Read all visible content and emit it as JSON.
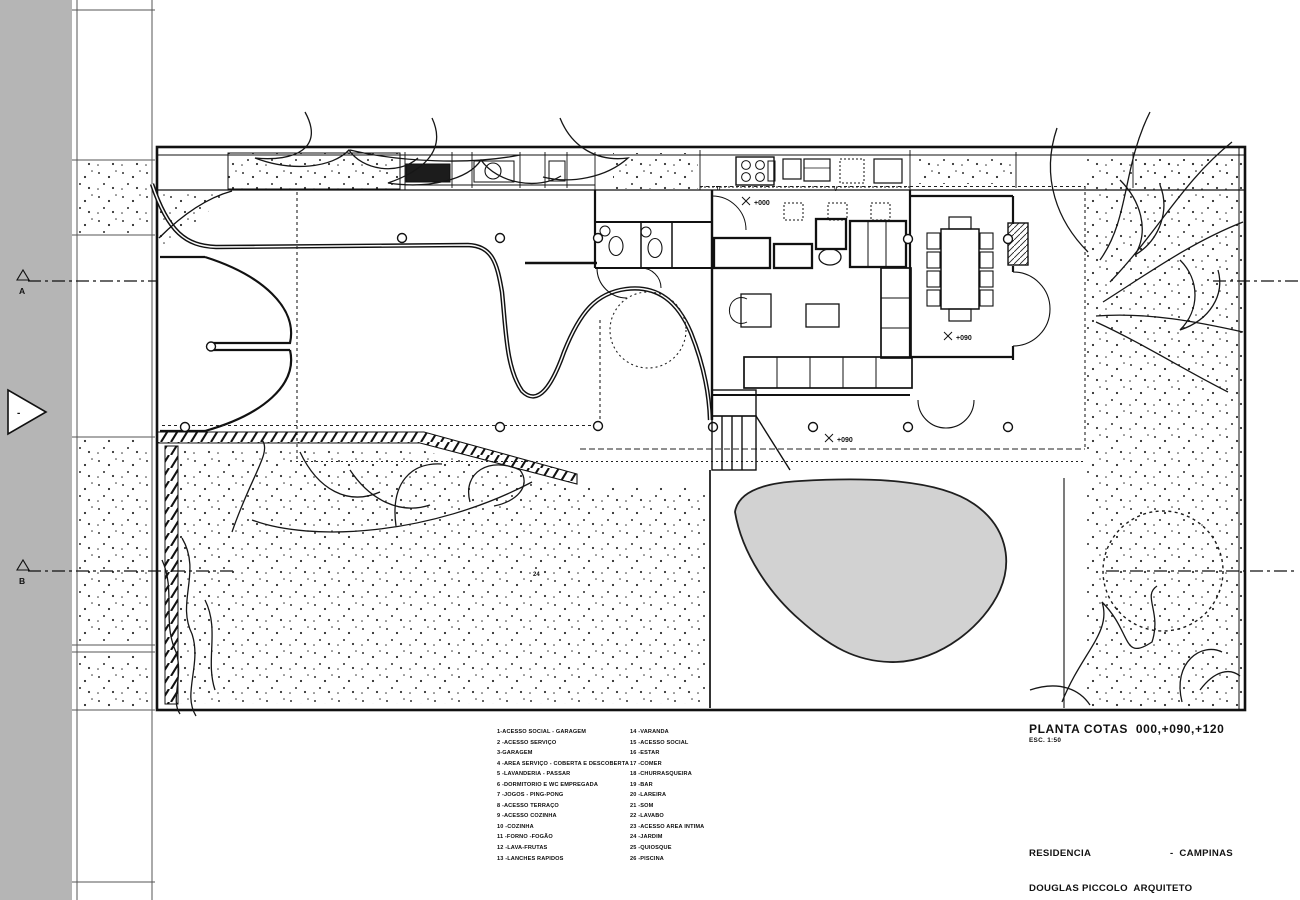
{
  "title_block": {
    "plan_title": "PLANTA COTAS  000,+090,+120",
    "scale": "ESC. 1:50",
    "project_name": "RESIDENCIA",
    "project_city": "-  CAMPINAS",
    "architect_line": "DOUGLAS PICCOLO  ARQUITETO",
    "phase_line": "ANTE PROJETO   SET/OUT/1977"
  },
  "section_markers": {
    "a": "A",
    "b": "B"
  },
  "level_annotations": {
    "kitchen_corridor": "+000",
    "dining": "+090",
    "terrace": "+090"
  },
  "plan_labels": {
    "garden_number": "24",
    "kitchen_mark_1": "TI",
    "kitchen_mark_2": "V",
    "north_arrow_mark": "-"
  },
  "legend": {
    "column_1": [
      "1-ACESSO SOCIAL - GARAGEM",
      "2 -ACESSO SERVIÇO",
      "3-GARAGEM",
      "4 -AREA SERVIÇO - COBERTA E DESCOBERTA",
      "5 -LAVANDERIA - PASSAR",
      "6 -DORMITORIO E WC EMPREGADA",
      "7 -JOGOS - PING-PONG",
      "8 -ACESSO TERRAÇO",
      "9 -ACESSO COZINHA",
      "10 -COZINHA",
      "11 -FORNO -FOGÃO",
      "12 -LAVA-FRUTAS",
      "13 -LANCHES RAPIDOS"
    ],
    "column_2": [
      "14 -VARANDA",
      "15 -ACESSO SOCIAL",
      "16 -ESTAR",
      "17 -COMER",
      "18 -CHURRASQUEIRA",
      "19 -BAR",
      "20 -LAREIRA",
      "21 -SOM",
      "22 -LAVABO",
      "23 -ACESSO AREA INTIMA",
      "24 -JARDIM",
      "25 -QUIOSQUE",
      "26 -PISCINA"
    ]
  },
  "colors": {
    "street_gray": "#b5b5b5",
    "pool_gray": "#d2d2d2",
    "line_black": "#141414"
  }
}
